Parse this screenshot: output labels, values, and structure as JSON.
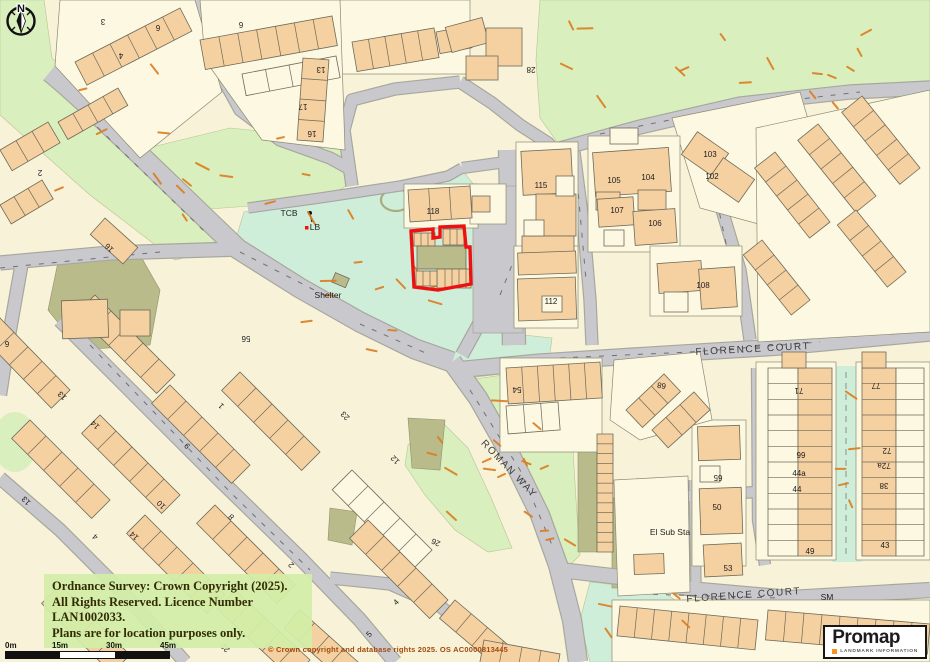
{
  "map": {
    "street_labels": [
      {
        "text": "FLORENCE COURT",
        "x": 753,
        "y": 352,
        "rot": -3,
        "size": 10,
        "spacing": 1.6
      },
      {
        "text": "ROMAN WAY",
        "x": 507,
        "y": 471,
        "rot": 46,
        "size": 10,
        "spacing": 1.6
      },
      {
        "text": "FLORENCE COURT",
        "x": 744,
        "y": 598,
        "rot": -4,
        "size": 10,
        "spacing": 1.6
      }
    ],
    "feature_labels": [
      {
        "text": "TCB",
        "x": 289,
        "y": 216
      },
      {
        "text": "LB",
        "x": 315,
        "y": 230
      },
      {
        "text": "Shelter",
        "x": 328,
        "y": 298
      },
      {
        "text": "El Sub Sta",
        "x": 670,
        "y": 535
      },
      {
        "text": "SM",
        "x": 827,
        "y": 600
      }
    ],
    "house_numbers": [
      {
        "text": "118",
        "x": 433,
        "y": 214,
        "rot": 0
      },
      {
        "text": "115",
        "x": 541,
        "y": 188,
        "rot": 0
      },
      {
        "text": "105",
        "x": 614,
        "y": 183,
        "rot": 0
      },
      {
        "text": "104",
        "x": 648,
        "y": 180,
        "rot": 0
      },
      {
        "text": "103",
        "x": 710,
        "y": 157,
        "rot": 0
      },
      {
        "text": "102",
        "x": 712,
        "y": 179,
        "rot": 0
      },
      {
        "text": "107",
        "x": 617,
        "y": 213,
        "rot": 0
      },
      {
        "text": "106",
        "x": 655,
        "y": 226,
        "rot": 0
      },
      {
        "text": "112",
        "x": 551,
        "y": 304,
        "rot": 0
      },
      {
        "text": "108",
        "x": 703,
        "y": 288,
        "rot": 0
      },
      {
        "text": "28",
        "x": 531,
        "y": 67,
        "rot": 180
      },
      {
        "text": "13",
        "x": 321,
        "y": 67,
        "rot": 180
      },
      {
        "text": "17",
        "x": 303,
        "y": 104,
        "rot": 180
      },
      {
        "text": "16",
        "x": 312,
        "y": 131,
        "rot": 180
      },
      {
        "text": "3",
        "x": 103,
        "y": 19,
        "rot": 180
      },
      {
        "text": "4",
        "x": 121,
        "y": 53,
        "rot": 180
      },
      {
        "text": "6",
        "x": 158,
        "y": 25,
        "rot": 180
      },
      {
        "text": "6",
        "x": 241,
        "y": 22,
        "rot": 180
      },
      {
        "text": "2",
        "x": 40,
        "y": 170,
        "rot": 180
      },
      {
        "text": "16",
        "x": 111,
        "y": 246,
        "rot": 225
      },
      {
        "text": "56",
        "x": 246,
        "y": 336,
        "rot": 180
      },
      {
        "text": "6",
        "x": 7,
        "y": 341,
        "rot": 180
      },
      {
        "text": "54",
        "x": 517,
        "y": 387,
        "rot": 180
      },
      {
        "text": "68",
        "x": 662,
        "y": 383,
        "rot": 190
      },
      {
        "text": "71",
        "x": 799,
        "y": 388,
        "rot": 180
      },
      {
        "text": "77",
        "x": 876,
        "y": 383,
        "rot": 180
      },
      {
        "text": "99",
        "x": 801,
        "y": 458,
        "rot": 0
      },
      {
        "text": "44a",
        "x": 799,
        "y": 476,
        "rot": 0
      },
      {
        "text": "44",
        "x": 797,
        "y": 492,
        "rot": 0
      },
      {
        "text": "72",
        "x": 887,
        "y": 448,
        "rot": 180
      },
      {
        "text": "72a",
        "x": 884,
        "y": 463,
        "rot": 180
      },
      {
        "text": "38",
        "x": 884,
        "y": 483,
        "rot": 180
      },
      {
        "text": "65",
        "x": 718,
        "y": 475,
        "rot": 180
      },
      {
        "text": "50",
        "x": 717,
        "y": 510,
        "rot": 0
      },
      {
        "text": "49",
        "x": 810,
        "y": 554,
        "rot": 0
      },
      {
        "text": "43",
        "x": 885,
        "y": 548,
        "rot": 0
      },
      {
        "text": "53",
        "x": 728,
        "y": 571,
        "rot": 0
      },
      {
        "text": "13",
        "x": 64,
        "y": 394,
        "rot": 225
      },
      {
        "text": "14",
        "x": 97,
        "y": 423,
        "rot": 225
      },
      {
        "text": "13",
        "x": 28,
        "y": 499,
        "rot": 225
      },
      {
        "text": "10",
        "x": 163,
        "y": 503,
        "rot": 225
      },
      {
        "text": "14",
        "x": 136,
        "y": 534,
        "rot": 225
      },
      {
        "text": "4",
        "x": 97,
        "y": 535,
        "rot": 225
      },
      {
        "text": "9",
        "x": 189,
        "y": 444,
        "rot": 225
      },
      {
        "text": "1",
        "x": 223,
        "y": 404,
        "rot": 225
      },
      {
        "text": "8",
        "x": 233,
        "y": 515,
        "rot": 225
      },
      {
        "text": "2",
        "x": 293,
        "y": 563,
        "rot": 225
      },
      {
        "text": "23",
        "x": 347,
        "y": 414,
        "rot": 225
      },
      {
        "text": "12",
        "x": 397,
        "y": 458,
        "rot": 225
      },
      {
        "text": "26",
        "x": 437,
        "y": 540,
        "rot": 205
      },
      {
        "text": "22",
        "x": 227,
        "y": 646,
        "rot": 225
      },
      {
        "text": "4",
        "x": 398,
        "y": 604,
        "rot": 315
      },
      {
        "text": "5",
        "x": 371,
        "y": 636,
        "rot": 315
      }
    ]
  },
  "overlays": {
    "copyright_notice": {
      "line1": "Ordnance Survey: Crown Copyright (2025).",
      "line2": "All Rights Reserved. Licence Number LAN1002033.",
      "line3": "Plans are for location purposes only."
    },
    "footer_credit": "© Crown copyright and database rights 2025. OS AC0000813445",
    "scale_bar": {
      "tick_labels": [
        "0m",
        "15m",
        "30m",
        "45m"
      ]
    },
    "compass": {
      "label": "N"
    },
    "logo": {
      "brand": "Promap",
      "tagline": "LANDMARK INFORMATION"
    }
  },
  "colors": {
    "plot_outline": "#ee1111",
    "road": "#c9c9cd",
    "road_edge": "#a7a79f",
    "grass": "#d9efbe",
    "mint": "#cfeeda",
    "olive": "#b9bb8b",
    "building": "#f5d0a1",
    "parcel": "#fcf8e2",
    "veg_dash": "#dd7c1e",
    "accent_orange": "#f7941d"
  }
}
